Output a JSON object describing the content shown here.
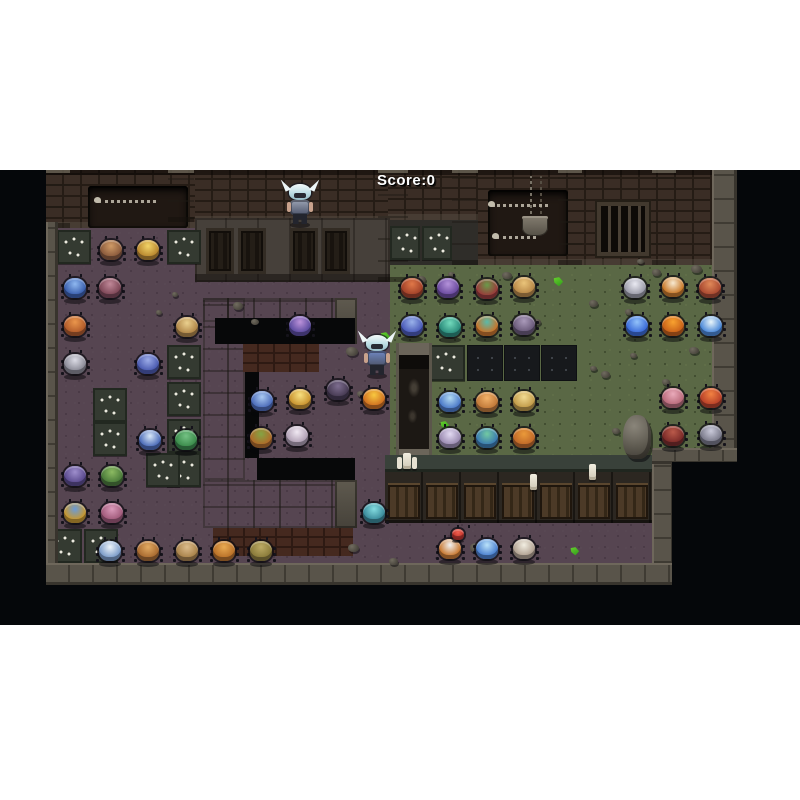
{
  "hud": {
    "score_label": "Score:0"
  },
  "palette": {
    "page_bg": "#ffffff",
    "letterbox": "#05070a",
    "floor_purple": "#564551",
    "floor_green": "#5a6845",
    "brick": "#3a2d25",
    "stone": "#59544a",
    "trap_tile": "#343a31",
    "caltrop": "#eceadf",
    "hud_text": "#ffffff"
  },
  "scene": {
    "viewport": {
      "x": 0,
      "y": 170,
      "w": 800,
      "h": 455
    },
    "rects": [
      [
        "floor-purple",
        46,
        52,
        344,
        341
      ],
      [
        "floor-green",
        390,
        92,
        322,
        196
      ],
      [
        "floor-purple",
        390,
        350,
        262,
        43
      ],
      [
        "floor-dark",
        388,
        50,
        90,
        45
      ],
      [
        "wall-brick",
        46,
        0,
        149,
        58
      ],
      [
        "wall-brick",
        195,
        0,
        193,
        52
      ],
      [
        "wall-brick",
        388,
        0,
        349,
        50
      ],
      [
        "wall-brick",
        478,
        0,
        259,
        95
      ],
      [
        "cabinet-row",
        195,
        48,
        195,
        64
      ],
      [
        "cabinet-panel",
        206,
        58,
        28,
        46
      ],
      [
        "cabinet-panel",
        238,
        58,
        28,
        46
      ],
      [
        "cabinet-panel",
        290,
        58,
        28,
        46
      ],
      [
        "cabinet-panel",
        322,
        58,
        28,
        46
      ],
      [
        "alcove",
        88,
        16,
        100,
        42
      ],
      [
        "alcove",
        488,
        20,
        80,
        66
      ],
      [
        "gate",
        597,
        32,
        52,
        54
      ],
      [
        "chain",
        528,
        6,
        16,
        44
      ],
      [
        "bucket",
        522,
        46,
        26,
        20
      ],
      [
        "bone-pile",
        98,
        30,
        58,
        8
      ],
      [
        "bone-pile",
        492,
        34,
        56,
        8
      ],
      [
        "bone-pile",
        496,
        66,
        40,
        8
      ],
      [
        "pillar",
        46,
        0,
        24,
        58
      ],
      [
        "pillar",
        168,
        0,
        26,
        52
      ],
      [
        "pillar",
        378,
        0,
        30,
        112
      ],
      [
        "pillar",
        452,
        0,
        26,
        95
      ],
      [
        "pillar",
        558,
        0,
        24,
        95
      ],
      [
        "pillar",
        652,
        0,
        24,
        95
      ],
      [
        "cwall",
        203,
        128,
        154,
        24
      ],
      [
        "cwall",
        203,
        128,
        42,
        182
      ],
      [
        "cwall",
        203,
        310,
        154,
        48
      ],
      [
        "cwall-cap",
        335,
        128,
        22,
        46
      ],
      [
        "cwall-cap",
        335,
        310,
        22,
        48
      ],
      [
        "void",
        215,
        148,
        140,
        26
      ],
      [
        "void",
        245,
        148,
        14,
        140
      ],
      [
        "void",
        257,
        288,
        98,
        22
      ],
      [
        "brick-face",
        243,
        174,
        76,
        28
      ],
      [
        "brick-face",
        213,
        358,
        140,
        28
      ],
      [
        "trap-tile",
        57,
        60,
        34,
        34
      ],
      [
        "trap-tile",
        167,
        60,
        34,
        34
      ],
      [
        "trap-tile",
        390,
        56,
        30,
        34
      ],
      [
        "trap-tile",
        422,
        56,
        30,
        34
      ],
      [
        "trap-tile",
        93,
        218,
        34,
        34
      ],
      [
        "trap-tile",
        93,
        252,
        34,
        34
      ],
      [
        "trap-tile",
        167,
        175,
        34,
        34
      ],
      [
        "trap-tile",
        167,
        212,
        34,
        34
      ],
      [
        "trap-tile",
        167,
        249,
        34,
        34
      ],
      [
        "trap-tile",
        167,
        283,
        34,
        34
      ],
      [
        "trap-tile",
        146,
        283,
        34,
        34
      ],
      [
        "trap-tile",
        48,
        359,
        34,
        34
      ],
      [
        "trap-tile",
        84,
        359,
        34,
        34
      ],
      [
        "trap-tile",
        429,
        175,
        36,
        36
      ],
      [
        "dark-tile",
        467,
        175,
        36,
        36
      ],
      [
        "dark-tile",
        504,
        175,
        36,
        36
      ],
      [
        "dark-tile",
        541,
        175,
        36,
        36
      ],
      [
        "altar",
        396,
        173,
        36,
        118
      ],
      [
        "locker-row",
        385,
        285,
        270,
        68
      ],
      [
        "locker-panel",
        388,
        315,
        32,
        34
      ],
      [
        "locker-panel",
        426,
        315,
        32,
        34
      ],
      [
        "locker-panel",
        464,
        315,
        32,
        34
      ],
      [
        "locker-panel",
        502,
        315,
        32,
        34
      ],
      [
        "locker-panel",
        540,
        315,
        32,
        34
      ],
      [
        "locker-panel",
        578,
        315,
        32,
        34
      ],
      [
        "locker-panel",
        616,
        315,
        32,
        34
      ],
      [
        "border-v",
        46,
        52,
        12,
        341
      ],
      [
        "border-v",
        712,
        0,
        25,
        292
      ],
      [
        "border-h",
        652,
        278,
        85,
        16
      ],
      [
        "border-v",
        652,
        294,
        22,
        121
      ],
      [
        "border-h",
        46,
        393,
        628,
        22
      ],
      [
        "big-rock",
        623,
        245,
        28,
        44
      ],
      [
        "rock",
        233,
        132,
        10,
        8
      ],
      [
        "rock",
        251,
        149,
        8,
        6
      ],
      [
        "rock",
        293,
        157,
        9,
        7
      ],
      [
        "rock",
        346,
        177,
        12,
        9
      ],
      [
        "rock",
        357,
        221,
        8,
        6
      ],
      [
        "rock",
        172,
        122,
        6,
        5
      ],
      [
        "rock",
        156,
        140,
        6,
        5
      ],
      [
        "rock",
        348,
        374,
        11,
        8
      ],
      [
        "rock",
        389,
        388,
        9,
        7
      ],
      [
        "rock",
        470,
        373,
        13,
        10
      ],
      [
        "rock",
        417,
        106,
        9,
        7
      ],
      [
        "rock",
        448,
        102,
        7,
        5
      ],
      [
        "rock",
        502,
        102,
        10,
        7
      ],
      [
        "rock",
        533,
        149,
        8,
        6
      ],
      [
        "rock",
        589,
        130,
        9,
        7
      ],
      [
        "rock",
        625,
        139,
        8,
        6
      ],
      [
        "rock",
        652,
        99,
        9,
        7
      ],
      [
        "rock",
        691,
        95,
        11,
        8
      ],
      [
        "rock",
        601,
        201,
        9,
        7
      ],
      [
        "rock",
        662,
        209,
        8,
        6
      ],
      [
        "rock",
        630,
        183,
        7,
        5
      ],
      [
        "rock",
        689,
        177,
        10,
        7
      ],
      [
        "rock",
        612,
        258,
        8,
        6
      ],
      [
        "rock",
        590,
        196,
        7,
        5
      ],
      [
        "rock",
        637,
        89,
        7,
        5
      ],
      [
        "green-item",
        553,
        107,
        10,
        9
      ],
      [
        "green-item",
        380,
        162,
        10,
        9
      ],
      [
        "green-item",
        440,
        251,
        9,
        8
      ],
      [
        "green-item",
        570,
        377,
        9,
        8
      ],
      [
        "candle-triple",
        403,
        283,
        8,
        16
      ],
      [
        "candle",
        530,
        304,
        7,
        16
      ],
      [
        "candle",
        589,
        294,
        7,
        16
      ],
      [
        "mask",
        672,
        292,
        128,
        163
      ]
    ],
    "monsters": [
      {
        "n": "brown-round",
        "x": 111,
        "y": 82,
        "c1": "#8a5a3c",
        "c2": "#cf9a66"
      },
      {
        "n": "gold-ornate",
        "x": 148,
        "y": 82,
        "c1": "#b8862e",
        "c2": "#f2d468"
      },
      {
        "n": "blue-crab",
        "x": 75,
        "y": 120,
        "c1": "#3a5fae",
        "c2": "#8fb8f0"
      },
      {
        "n": "maroon-spider",
        "x": 110,
        "y": 120,
        "c1": "#7c4656",
        "c2": "#c08898"
      },
      {
        "n": "orange-ball",
        "x": 75,
        "y": 158,
        "c1": "#b05a2a",
        "c2": "#ea964c"
      },
      {
        "n": "tan-butterfly",
        "x": 187,
        "y": 159,
        "c1": "#b08648",
        "c2": "#ead08e"
      },
      {
        "n": "grey-spider",
        "x": 75,
        "y": 196,
        "c1": "#8a8a96",
        "c2": "#dcdce6"
      },
      {
        "n": "blue-butterfly",
        "x": 148,
        "y": 196,
        "c1": "#4a5ab0",
        "c2": "#9cace8"
      },
      {
        "n": "violet-butterfly",
        "x": 300,
        "y": 158,
        "c1": "#5a4a9e",
        "c2": "#bc92da"
      },
      {
        "n": "dark-moth",
        "x": 338,
        "y": 222,
        "c1": "#463a52",
        "c2": "#7e6e90"
      },
      {
        "n": "blue-spider",
        "x": 262,
        "y": 233,
        "c1": "#4a6ab8",
        "c2": "#aacaf2"
      },
      {
        "n": "gold-beetle",
        "x": 300,
        "y": 231,
        "c1": "#c8922e",
        "c2": "#f8e080"
      },
      {
        "n": "orange-green-bug",
        "x": 261,
        "y": 270,
        "c1": "#b06a28",
        "c2": "#84a444"
      },
      {
        "n": "white-spider",
        "x": 297,
        "y": 268,
        "c1": "#b0a0b4",
        "c2": "#f0e8f2"
      },
      {
        "n": "flame-bug",
        "x": 374,
        "y": 231,
        "c1": "#d07020",
        "c2": "#f8c840"
      },
      {
        "n": "teal-bug",
        "x": 374,
        "y": 345,
        "c1": "#3a8a9a",
        "c2": "#84dce0"
      },
      {
        "n": "purple-spider",
        "x": 75,
        "y": 308,
        "c1": "#5a4a8e",
        "c2": "#9e8ecc"
      },
      {
        "n": "green-bug",
        "x": 112,
        "y": 308,
        "c1": "#4a7a3a",
        "c2": "#8cba62"
      },
      {
        "n": "blue-white-bug",
        "x": 150,
        "y": 272,
        "c1": "#4a6ab8",
        "c2": "#d8e8f8"
      },
      {
        "n": "green-mantis",
        "x": 186,
        "y": 272,
        "c1": "#3a8a4a",
        "c2": "#74c284"
      },
      {
        "n": "gold-knight-bug",
        "x": 75,
        "y": 345,
        "c1": "#c8982e",
        "c2": "#6a9ad8"
      },
      {
        "n": "pink-fluff",
        "x": 112,
        "y": 345,
        "c1": "#a05a7a",
        "c2": "#da9aba"
      },
      {
        "n": "white-diamond-bug",
        "x": 110,
        "y": 383,
        "c1": "#7a9ac8",
        "c2": "#eef4fa"
      },
      {
        "n": "orange-shell-bug",
        "x": 148,
        "y": 383,
        "c1": "#a86a30",
        "c2": "#e2aa62"
      },
      {
        "n": "tan-moth",
        "x": 187,
        "y": 383,
        "c1": "#a8824a",
        "c2": "#dcbc8c"
      },
      {
        "n": "orange-butterfly",
        "x": 224,
        "y": 383,
        "c1": "#b87028",
        "c2": "#eaaa52"
      },
      {
        "n": "turtle-bug",
        "x": 261,
        "y": 383,
        "c1": "#8a7a3a",
        "c2": "#bcaa64"
      },
      {
        "n": "red-beetle",
        "x": 412,
        "y": 120,
        "c1": "#a04028",
        "c2": "#e07848"
      },
      {
        "n": "purple-butterfly",
        "x": 448,
        "y": 120,
        "c1": "#6a4a9e",
        "c2": "#b492da"
      },
      {
        "n": "red-green-bug",
        "x": 487,
        "y": 121,
        "c1": "#9a3a3a",
        "c2": "#6a9a4a"
      },
      {
        "n": "tan-beetle",
        "x": 524,
        "y": 119,
        "c1": "#b88848",
        "c2": "#eac47a"
      },
      {
        "n": "white-grey-spider",
        "x": 635,
        "y": 120,
        "c1": "#9a9aa8",
        "c2": "#eaeaf2"
      },
      {
        "n": "orange-striped-beetle",
        "x": 673,
        "y": 119,
        "c1": "#c87828",
        "c2": "#f8ead2"
      },
      {
        "n": "rust-beetle",
        "x": 710,
        "y": 120,
        "c1": "#a84830",
        "c2": "#e08858"
      },
      {
        "n": "blue-moth",
        "x": 412,
        "y": 158,
        "c1": "#4a5ab8",
        "c2": "#9ab2ea"
      },
      {
        "n": "teal-spider",
        "x": 450,
        "y": 159,
        "c1": "#2a8a7a",
        "c2": "#72dabc"
      },
      {
        "n": "orange-teal-spider",
        "x": 487,
        "y": 158,
        "c1": "#c8742a",
        "c2": "#5abaaa"
      },
      {
        "n": "mauve-spider",
        "x": 524,
        "y": 157,
        "c1": "#6a5a7a",
        "c2": "#aa9aba"
      },
      {
        "n": "cobalt-spider",
        "x": 637,
        "y": 158,
        "c1": "#3a6ad8",
        "c2": "#92c2fa"
      },
      {
        "n": "flame-spider",
        "x": 673,
        "y": 158,
        "c1": "#c86018",
        "c2": "#f8a230"
      },
      {
        "n": "blue-orb-bug",
        "x": 711,
        "y": 158,
        "c1": "#4a88d8",
        "c2": "#eaf6fa"
      },
      {
        "n": "crystal-bug",
        "x": 450,
        "y": 234,
        "c1": "#4a78c8",
        "c2": "#b2daf2"
      },
      {
        "n": "amber-moth",
        "x": 487,
        "y": 234,
        "c1": "#c07838",
        "c2": "#f2b26a"
      },
      {
        "n": "gold-moth",
        "x": 524,
        "y": 233,
        "c1": "#c09a48",
        "c2": "#f2da92"
      },
      {
        "n": "pink-crab",
        "x": 673,
        "y": 230,
        "c1": "#b86a7a",
        "c2": "#eaaaba"
      },
      {
        "n": "scarlet-butterfly",
        "x": 711,
        "y": 230,
        "c1": "#b84028",
        "c2": "#f28242"
      },
      {
        "n": "lilac-spider",
        "x": 450,
        "y": 270,
        "c1": "#9a8ab0",
        "c2": "#e2daf2"
      },
      {
        "n": "teal-dragonfly",
        "x": 487,
        "y": 270,
        "c1": "#3a7ab0",
        "c2": "#72caa2"
      },
      {
        "n": "pumpkin-bug",
        "x": 524,
        "y": 270,
        "c1": "#c06828",
        "c2": "#ea9a3a"
      },
      {
        "n": "dark-red-beetle",
        "x": 673,
        "y": 268,
        "c1": "#7a2a28",
        "c2": "#ba5a4a"
      },
      {
        "n": "ash-spider",
        "x": 711,
        "y": 267,
        "c1": "#7a7a8a",
        "c2": "#cacada"
      },
      {
        "n": "orange-white-butterfly",
        "x": 450,
        "y": 381,
        "c1": "#c87830",
        "c2": "#f2f2f2"
      },
      {
        "n": "ice-crystal-bug",
        "x": 487,
        "y": 381,
        "c1": "#4a80d0",
        "c2": "#bae2fa"
      },
      {
        "n": "pale-moth",
        "x": 524,
        "y": 381,
        "c1": "#b0a090",
        "c2": "#f2eee2"
      },
      {
        "n": "red-hatchling",
        "x": 458,
        "y": 366,
        "c1": "#c03028",
        "c2": "#f06050",
        "s": 16
      }
    ],
    "heroes": [
      {
        "n": "hero-knight-top",
        "x": 286,
        "y": 14,
        "armor": "#9ba3b4"
      },
      {
        "n": "hero-knight-center",
        "x": 363,
        "y": 165,
        "armor": "#6f87c2"
      }
    ]
  }
}
